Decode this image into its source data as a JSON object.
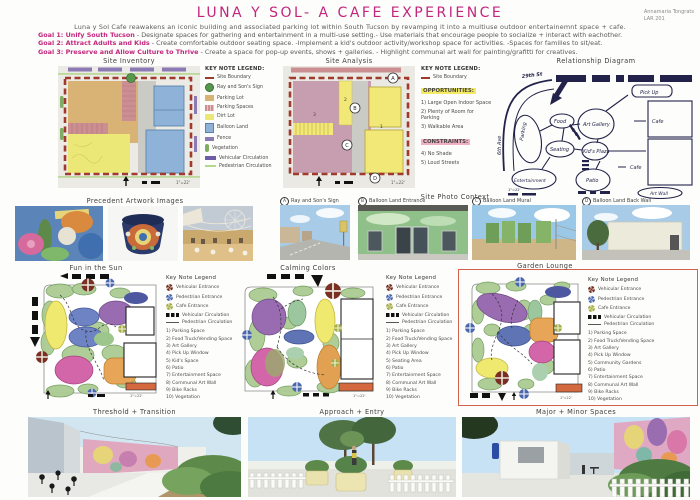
{
  "colors": {
    "accent_magenta": "#c2267d",
    "site_boundary_red": "#9e3a2b",
    "parking_lot_tan": "#d9b375",
    "parking_spaces_pink": "#cb8f92",
    "dirt_lot_yellow": "#ece878",
    "balloon_land_blue": "#8fb3d8",
    "fence_purple": "#8b7ab3",
    "vegetation_green": "#7fae63",
    "vehicular_circulation_purple": "#6f5ca8",
    "pedestrian_circulation_green": "#b5d98b",
    "opportunities_highlight": "#f4eb63",
    "constraints_highlight": "#efb2c3",
    "selected_concept_border": "#d4614b"
  },
  "plan_scale": "1\"=22'",
  "header": {
    "title": "LUNA Y SOL- A  CAFE EXPERIENCE",
    "author": "Annamaria Tongrats",
    "course": "LAR 201",
    "subtitle": "Luna y Sol Cafe reawakens an iconic building and associated parking lot within South Tucson by revamping it into a multiuse outdoor entertainemnt space + cafe.",
    "goals": [
      {
        "label": "Goal 1: Unify South Tucson",
        "text": "- Designate spaces for gathering and entertainment in a multi-use setting.- Use materials that encourage people to socialize + interact with eachother."
      },
      {
        "label": "Goal 2: Attract Adults and Kids",
        "text": "- Create comfortable outdoor seating space. -Implement a  kid's outdoor activity/workshop space for activities. -Spaces for families to sit/eat."
      },
      {
        "label": "Goal 3: Preserve and Allow Culture to Thrive",
        "text": "- Create a space for pop-up events, shows + galleries. - Highlight communal art wall for painting/grafitti for creatives."
      }
    ]
  },
  "site_inventory": {
    "title": "Site Inventory",
    "legend_title": "KEY NOTE LEGEND:",
    "legend": [
      {
        "label": "Site Boundary",
        "swatch": "boundary"
      },
      {
        "label": "Ray and Son's Sign",
        "swatch": "sign"
      },
      {
        "label": "Parking Lot",
        "swatch": "parking-lot"
      },
      {
        "label": "Parking Spaces",
        "swatch": "parking-spaces"
      },
      {
        "label": "Dirt Lot",
        "swatch": "dirt-lot"
      },
      {
        "label": "Balloon Land",
        "swatch": "balloon"
      },
      {
        "label": "Fence",
        "swatch": "fence"
      },
      {
        "label": "Vegetation",
        "swatch": "vegetation"
      },
      {
        "label": "Vehicular Circulation",
        "swatch": "vehicular"
      },
      {
        "label": "Pedestrian Circulation",
        "swatch": "pedestrian"
      }
    ]
  },
  "site_analysis": {
    "title": "Site Analysis",
    "legend_title": "KEY NOTE LEGEND:",
    "boundary_label": "Site Boundary",
    "opportunities_title": "OPPORTUNITIES:",
    "opportunities": [
      "1) Large Open Indoor Space",
      "2) Plenty of Room for Parking",
      "3) Walkable Area"
    ],
    "constraints_title": "CONSTRAINTS:",
    "constraints": [
      "4) No Shade",
      "5) Loud Streets"
    ],
    "markers": [
      "A",
      "B",
      "C",
      "D"
    ],
    "numbers": [
      "1",
      "2",
      "3"
    ]
  },
  "relationship_diagram": {
    "title": "Relationship Diagram",
    "labels": {
      "street_top": "29th St",
      "street_left": "6th Ave",
      "parking": "Parking",
      "food": "Food",
      "art_gallery": "Art Gallery",
      "pick_up": "Pick Up",
      "seating": "Seating",
      "kids_plaza": "Kid's Plaza",
      "cafe_top": "Cafe",
      "cafe_bottom": "Cafe",
      "entertainment": "Entertainment",
      "patio": "Patio",
      "art_wall": "Art Wall"
    }
  },
  "precedent": {
    "title": "Precedent Artwork Images"
  },
  "photo_context": {
    "title": "Site Photo Context",
    "photos": [
      {
        "letter": "A",
        "caption": "Ray and Son's Sign"
      },
      {
        "letter": "B",
        "caption": "Balloon Land Entrance"
      },
      {
        "letter": "C",
        "caption": "Balloon Land Mural"
      },
      {
        "letter": "D",
        "caption": "Balloon Land Back Wall"
      }
    ]
  },
  "concept_legend": {
    "title": "Key Note Legend",
    "entrances": [
      {
        "icon": "vehicular-entrance",
        "label": "Vehicular Entrance"
      },
      {
        "icon": "pedestrian-entrance",
        "label": "Pedestrian Entrance"
      },
      {
        "icon": "cafe-entrance",
        "label": "Cafe Entrance"
      },
      {
        "icon": "vehicular-circulation",
        "label": "Vehicular Circulation"
      },
      {
        "icon": "pedestrian-circulation",
        "label": "Pedestrian Circulation"
      }
    ]
  },
  "concepts": [
    {
      "title": "Fun in the Sun",
      "selected": false,
      "items": [
        "1) Parking Space",
        "2) Food Truck/Vending Space",
        "3) Art Gallery",
        "4) Pick Up Window",
        "5) Kid's Space",
        "6) Patio",
        "7) Entertainment Space",
        "8) Communal Art Wall",
        "9) Bike Racks",
        "10) Vegetation"
      ]
    },
    {
      "title": "Calming Colors",
      "selected": false,
      "items": [
        "1) Parking Space",
        "2) Food Truck/Vending Space",
        "3) Art Gallery",
        "4) Pick Up Window",
        "5) Seating Area",
        "6) Patio",
        "7) Entertainment Space",
        "8) Communal Art Wall",
        "9) Bike Racks",
        "10) Vegetation"
      ]
    },
    {
      "title": "Garden Lounge",
      "selected": true,
      "items": [
        "1) Parking Space",
        "2) Food Truck/Vending Space",
        "3) Art Gallery",
        "4) Pick Up Window",
        "5) Community Gardens",
        "6) Patio",
        "7) Entertainment Space",
        "8) Communal Art Wall",
        "9) Bike Racks",
        "10) Vegetation"
      ]
    }
  ],
  "renders": [
    {
      "title": "Threshold + Transition"
    },
    {
      "title": "Approach + Entry"
    },
    {
      "title": "Major + Minor Spaces"
    }
  ]
}
